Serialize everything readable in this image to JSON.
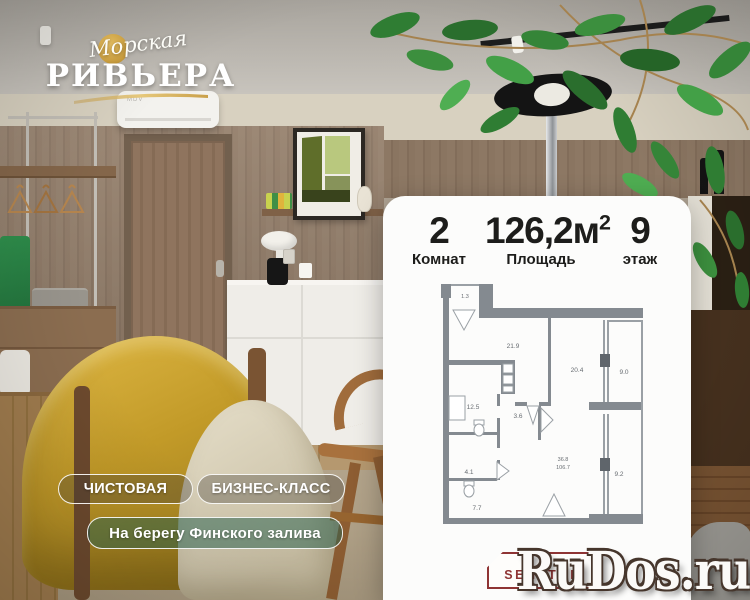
{
  "logo": {
    "script": "Морская",
    "name": "РИВЬЕРА"
  },
  "badges": [
    {
      "label": "ЧИСТОВАЯ"
    },
    {
      "label": "БИЗНЕС-КЛАСС"
    },
    {
      "label": "На берегу Финского залива"
    }
  ],
  "card": {
    "stats": [
      {
        "value": "2",
        "label": "Комнат"
      },
      {
        "value": "126,2",
        "unit": "м",
        "sup": "2",
        "label": "Площадь"
      },
      {
        "value": "9",
        "label": "этаж"
      }
    ]
  },
  "plan": {
    "rooms": [
      {
        "value": "1.3"
      },
      {
        "value": "21.9"
      },
      {
        "value": "20.4"
      },
      {
        "value": "9.0"
      },
      {
        "value": "12.5"
      },
      {
        "value": "3.6"
      },
      {
        "value": "4.1"
      },
      {
        "value": "7.7"
      },
      {
        "value": "36.8"
      },
      {
        "value": "106.7"
      },
      {
        "value": "9.2"
      }
    ]
  },
  "photo": {
    "ac_brand": "MDV"
  },
  "brand": {
    "text": "SENATOR"
  },
  "watermark": {
    "text": "RuDos.ru"
  },
  "colors": {
    "logo_gold": "#c69a3c",
    "badge_green": "#265f4e",
    "plan_wall": "#848a90",
    "senator_red": "#8f3434",
    "accent_yellow_chair": "#c29a28"
  }
}
